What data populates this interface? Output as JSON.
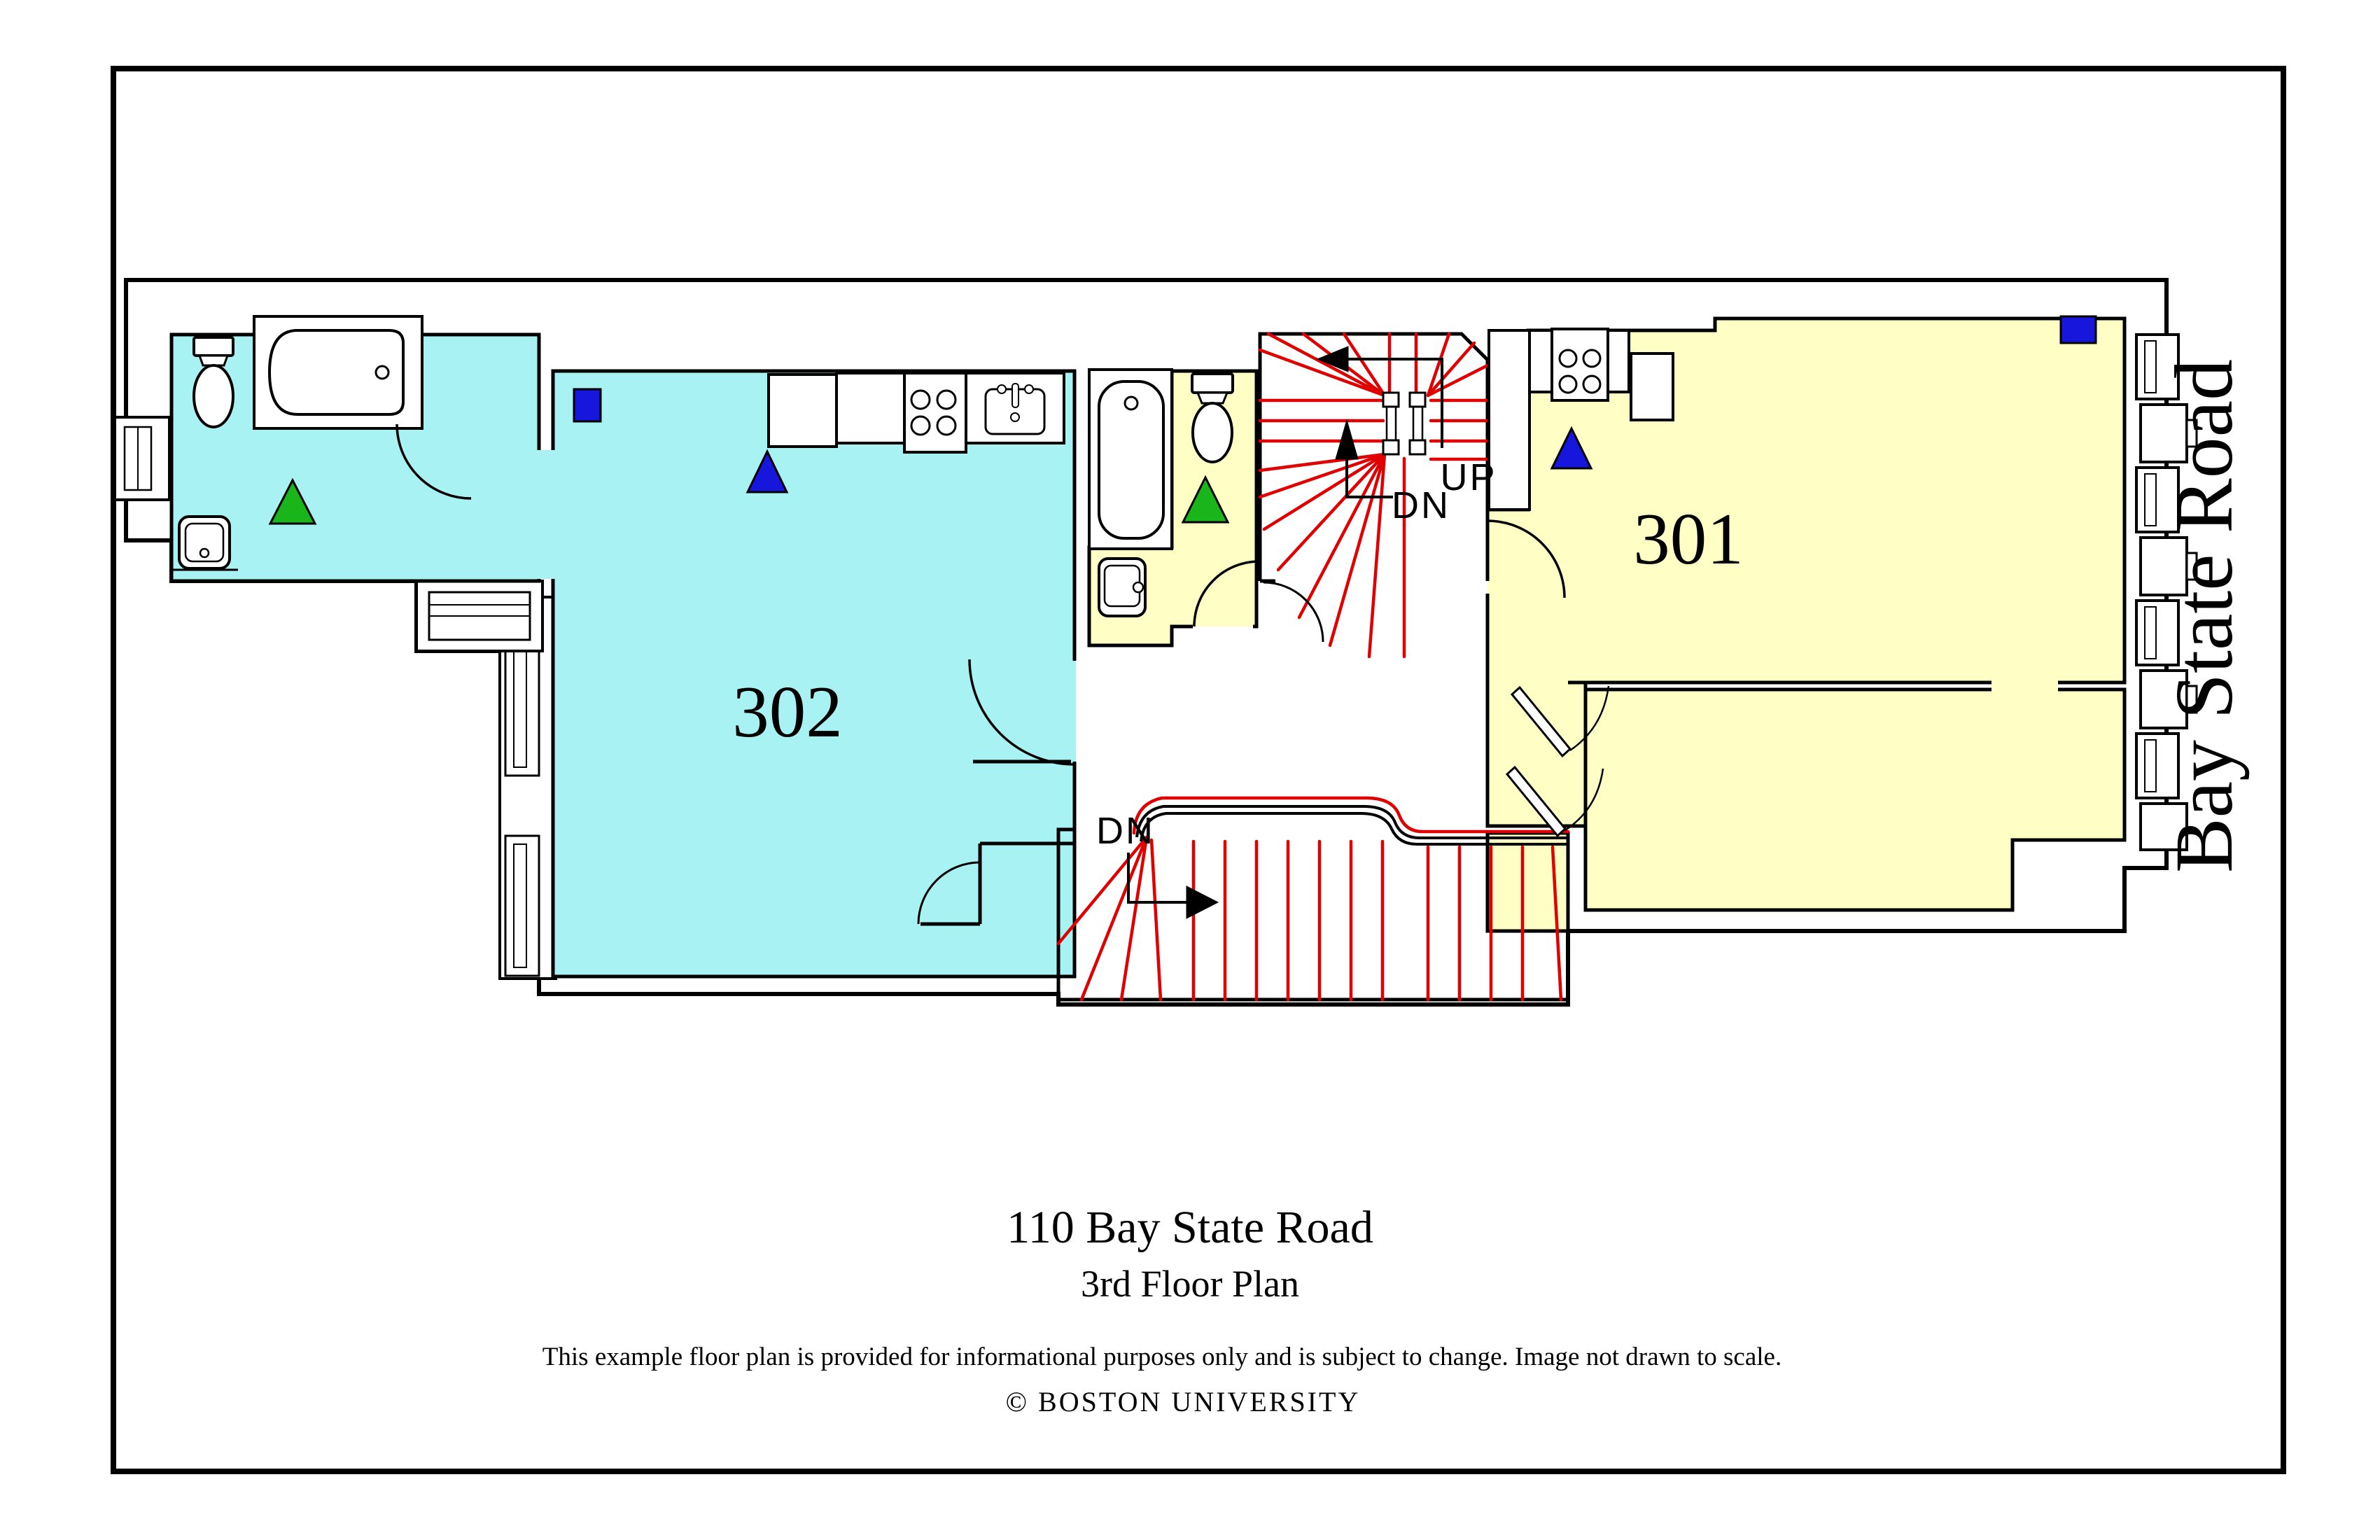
{
  "page": {
    "background": "#ffffff",
    "border_color": "#000000"
  },
  "floor_plan": {
    "street_label": "Bay State Road",
    "apartments": [
      {
        "number": "302",
        "floor_color": "#a9f2f4"
      },
      {
        "number": "301",
        "floor_color": "#ffffc5"
      }
    ],
    "stairwells": {
      "upper": {
        "up_label": "UP",
        "down_label": "DN"
      },
      "lower": {
        "down_label": "DN"
      },
      "tread_color": "#e00000"
    },
    "symbols": {
      "blue_square_color": "#1616dd",
      "blue_triangle_color": "#1616dd",
      "green_triangle_color": "#1ab51a"
    }
  },
  "footer": {
    "address": "110 Bay State Road",
    "plan_title": "3rd Floor Plan",
    "disclaimer": "This example floor plan is provided for informational purposes only and is subject to change. Image not drawn to scale.",
    "copyright": "© BOSTON UNIVERSITY"
  }
}
